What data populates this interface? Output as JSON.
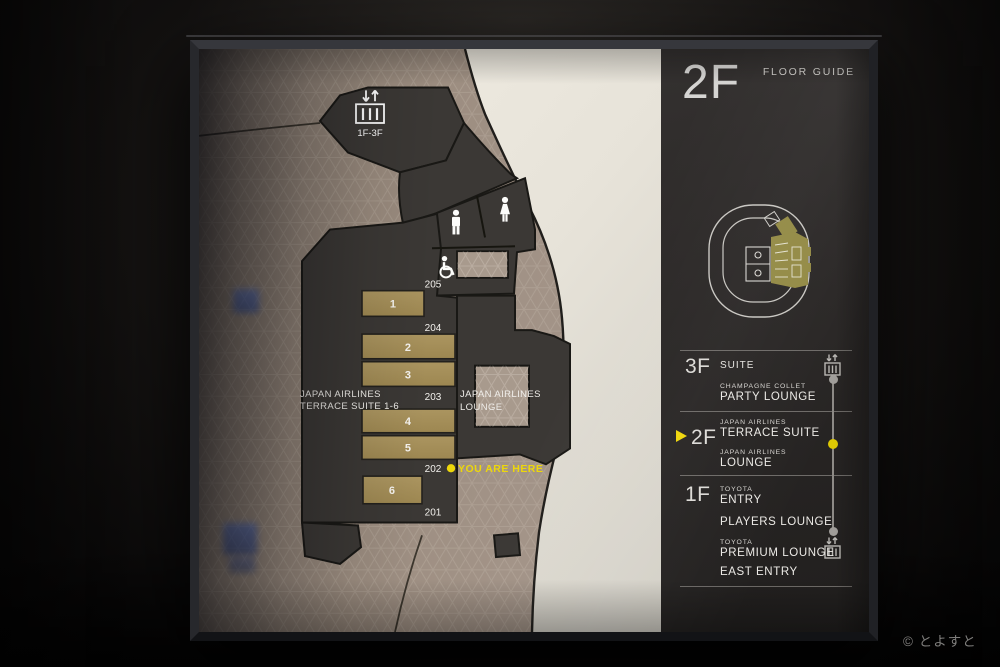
{
  "watermark": "© とよすと",
  "sign": {
    "header": {
      "floor_label": "2F",
      "guide_label": "FLOOR GUIDE"
    },
    "map": {
      "elevator_range_label": "1F-3F",
      "terrace_suite_label": [
        "JAPAN AIRLINES",
        "TERRACE SUITE 1-6"
      ],
      "lounge_label": [
        "JAPAN AIRLINES",
        "LOUNGE"
      ],
      "you_are_here_label": "YOU ARE HERE",
      "room_numbers": [
        "1",
        "2",
        "3",
        "4",
        "5",
        "6"
      ],
      "door_numbers": [
        "205",
        "204",
        "203",
        "202",
        "201"
      ]
    },
    "directory": {
      "floors": [
        {
          "id": "3F",
          "current": false,
          "entries": [
            {
              "sub": "",
              "name": "SUITE"
            },
            {
              "sub": "CHAMPAGNE COLLET",
              "name": "PARTY LOUNGE"
            }
          ]
        },
        {
          "id": "2F",
          "current": true,
          "entries": [
            {
              "sub": "JAPAN AIRLINES",
              "name": "TERRACE SUITE"
            },
            {
              "sub": "JAPAN AIRLINES",
              "name": "LOUNGE"
            }
          ]
        },
        {
          "id": "1F",
          "current": false,
          "entries": [
            {
              "sub": "TOYOTA",
              "name": "ENTRY"
            },
            {
              "sub": "",
              "name": "PLAYERS LOUNGE"
            },
            {
              "sub": "TOYOTA",
              "name": "PREMIUM LOUNGE"
            },
            {
              "sub": "",
              "name": "EAST ENTRY"
            }
          ]
        }
      ]
    },
    "colors": {
      "accent_yellow": "#edd70a",
      "room_olive": "#a7915b",
      "corridor_dark": "#3b3835",
      "concourse_tan": "#9a8b7e",
      "outer_cream": "#eae6dc",
      "panel_bg": "#2b2928",
      "minimap_highlight": "#938a45"
    }
  }
}
